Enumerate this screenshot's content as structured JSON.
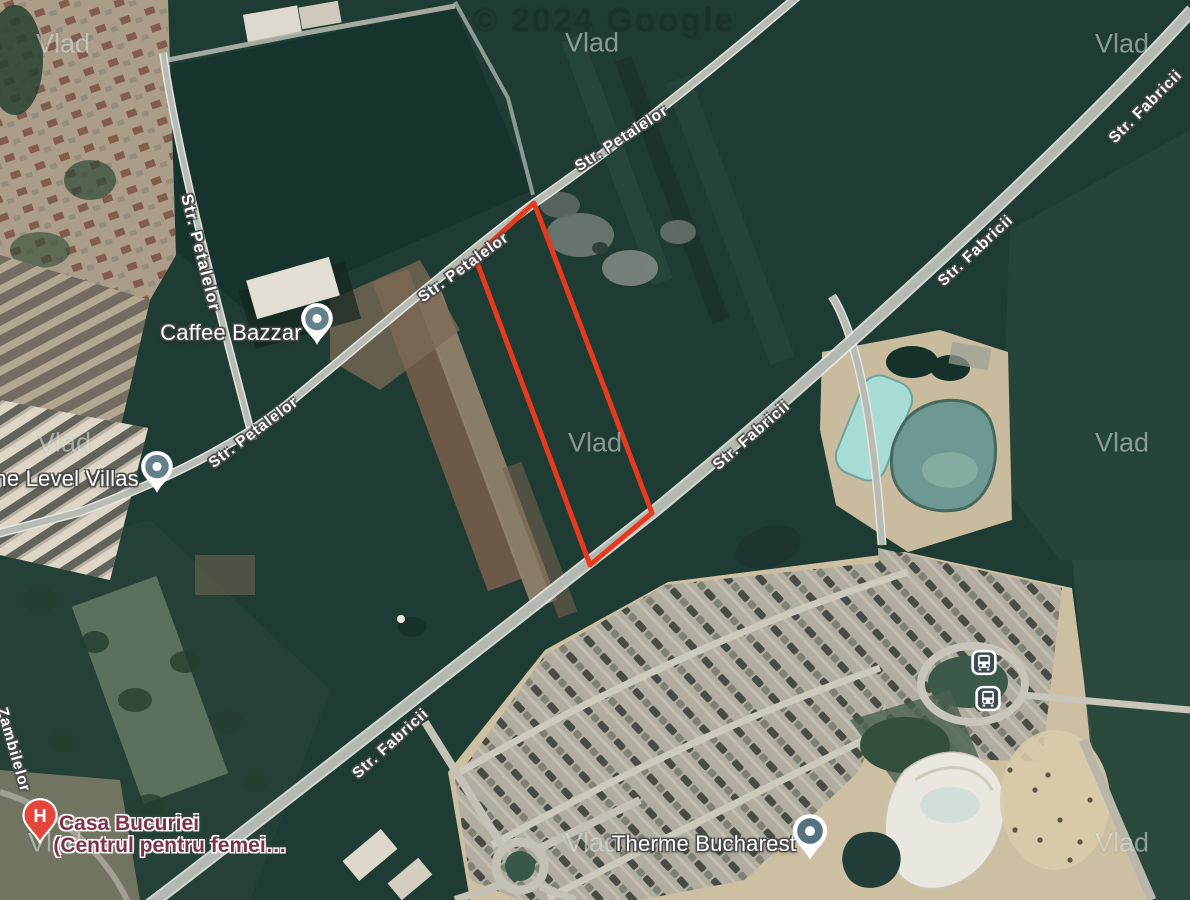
{
  "attribution": {
    "text": "© 2024 Google"
  },
  "watermark": {
    "text": "Vlad"
  },
  "property_outline": {
    "points": "534,203 652,513 590,565 475,257",
    "color": "#e8391c"
  },
  "street_labels": [
    {
      "text": "Str. Petalelor"
    },
    {
      "text": "Str. Petalelor"
    },
    {
      "text": "Str. Petalelor"
    },
    {
      "text": "Str. Petalelor"
    },
    {
      "text": "Str. Fabricii"
    },
    {
      "text": "Str. Fabricii"
    },
    {
      "text": "Str. Fabricii"
    },
    {
      "text": "Str. Fabricii"
    },
    {
      "text": "Zambilelor"
    }
  ],
  "pois": {
    "caffee_bazzar": {
      "label": "Caffee Bazzar"
    },
    "one_level_villas": {
      "label": "One Level Villas"
    },
    "therme_bucharest": {
      "label": "Therme Bucharest"
    },
    "casa_bucuriei": {
      "label": "Casa Bucuriei",
      "label_line2": "(Centrul pentru femei…",
      "pin_letter": "H"
    }
  },
  "transit": {
    "bus_stop_count": 2
  },
  "colors": {
    "property_outline": "#e8391c",
    "field_green": "#1f3c34",
    "sand": "#cdbfa1",
    "pool_water": "#a8dbd3",
    "pond_water": "#6d9992",
    "road": "#b4b8b2",
    "hospital_pin": "#e6453c",
    "poi_pin": "#64808c",
    "bus_icon": "#3e4a52",
    "health_label": "#7d3048"
  }
}
